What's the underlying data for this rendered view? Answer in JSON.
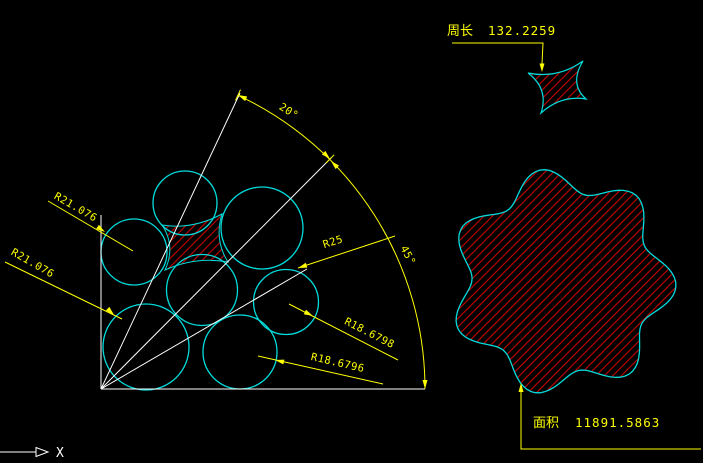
{
  "colors": {
    "background": "#000000",
    "outline": "#00dcdc",
    "dimension": "#ffff00",
    "construction": "#ffffff",
    "hatch": "#cc0000"
  },
  "left_figure": {
    "radius_labels": {
      "r21_top": "R21.076",
      "r21_bottom": "R21.076",
      "r25": "R25",
      "r18_right": "R18.6798",
      "r18_bottom": "R18.6796"
    },
    "angle_labels": {
      "upper": "20°",
      "lower": "45°"
    }
  },
  "perimeter_callout": {
    "label": "周长",
    "value": "132.2259"
  },
  "area_callout": {
    "label": "面积",
    "value": "11891.5863"
  },
  "axis_indicator": {
    "label": "X"
  }
}
